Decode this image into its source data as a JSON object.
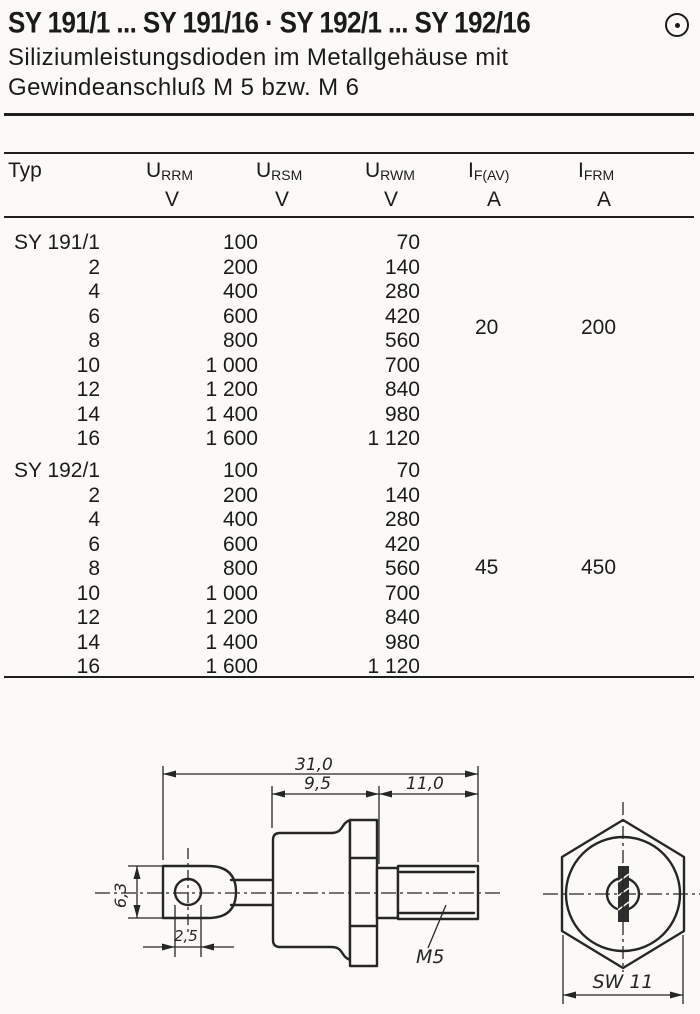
{
  "page": {
    "title": "SY 191/1 ... SY 191/16 · SY 192/1 ... SY 192/16",
    "corner_icon": "circled-dot",
    "subtitle_line1": "Siliziumleistungsdioden im Metallgehäuse mit",
    "subtitle_line2": "Gewindeanschluß M 5 bzw. M 6"
  },
  "table": {
    "typ_header": "Typ",
    "columns": [
      {
        "id": "u-rrm",
        "sym": "U",
        "sub": "RRM",
        "unit": "V"
      },
      {
        "id": "u-rsm",
        "sym": "U",
        "sub": "RSM",
        "unit": "V"
      },
      {
        "id": "u-rwm",
        "sym": "U",
        "sub": "RWM",
        "unit": "V"
      },
      {
        "id": "i-fav",
        "sym": "I",
        "sub": "F(AV)",
        "unit": "A"
      },
      {
        "id": "i-frm",
        "sym": "I",
        "sub": "FRM",
        "unit": "A"
      }
    ],
    "groups": [
      {
        "name": "SY 191",
        "if_av": "20",
        "ifrm": "200",
        "rows": [
          {
            "typ": "SY 191/1",
            "urrm": "100",
            "urwm": "70"
          },
          {
            "typ": "2",
            "urrm": "200",
            "urwm": "140"
          },
          {
            "typ": "4",
            "urrm": "400",
            "urwm": "280"
          },
          {
            "typ": "6",
            "urrm": "600",
            "urwm": "420"
          },
          {
            "typ": "8",
            "urrm": "800",
            "urwm": "560"
          },
          {
            "typ": "10",
            "urrm": "1 000",
            "urwm": "700"
          },
          {
            "typ": "12",
            "urrm": "1 200",
            "urwm": "840"
          },
          {
            "typ": "14",
            "urrm": "1 400",
            "urwm": "980"
          },
          {
            "typ": "16",
            "urrm": "1 600",
            "urwm": "1 120"
          }
        ]
      },
      {
        "name": "SY 192",
        "if_av": "45",
        "ifrm": "450",
        "rows": [
          {
            "typ": "SY 192/1",
            "urrm": "100",
            "urwm": "70"
          },
          {
            "typ": "2",
            "urrm": "200",
            "urwm": "140"
          },
          {
            "typ": "4",
            "urrm": "400",
            "urwm": "280"
          },
          {
            "typ": "6",
            "urrm": "600",
            "urwm": "420"
          },
          {
            "typ": "8",
            "urrm": "800",
            "urwm": "560"
          },
          {
            "typ": "10",
            "urrm": "1 000",
            "urwm": "700"
          },
          {
            "typ": "12",
            "urrm": "1 200",
            "urwm": "840"
          },
          {
            "typ": "14",
            "urrm": "1 400",
            "urwm": "980"
          },
          {
            "typ": "16",
            "urrm": "1 600",
            "urwm": "1 120"
          }
        ]
      }
    ]
  },
  "drawing": {
    "dims": {
      "overall_length": "31,0",
      "body_length": "9,5",
      "stud_length": "11,0",
      "lug_height": "6,3",
      "hole_width": "2,5",
      "thread": "M5",
      "wrench_size": "SW 11"
    }
  }
}
